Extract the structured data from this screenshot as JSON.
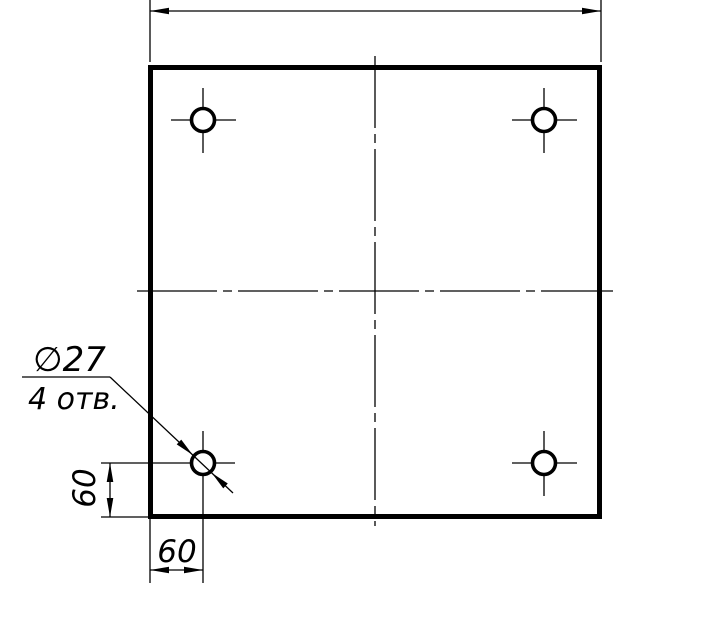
{
  "drawing": {
    "type": "engineering-drawing",
    "description": "Square plate with four drilled holes, GOST-style dimensioning",
    "labels": {
      "hole_diameter": "∅27",
      "hole_count": "4 отв.",
      "dim_left": "60",
      "dim_bottom": "60"
    },
    "values": {
      "hole_diameter": 27,
      "hole_count": 4,
      "hole_offset_from_left_edge": 60,
      "hole_offset_from_bottom_edge": 60
    },
    "colors": {
      "line": "#000000",
      "background": "#ffffff"
    }
  }
}
